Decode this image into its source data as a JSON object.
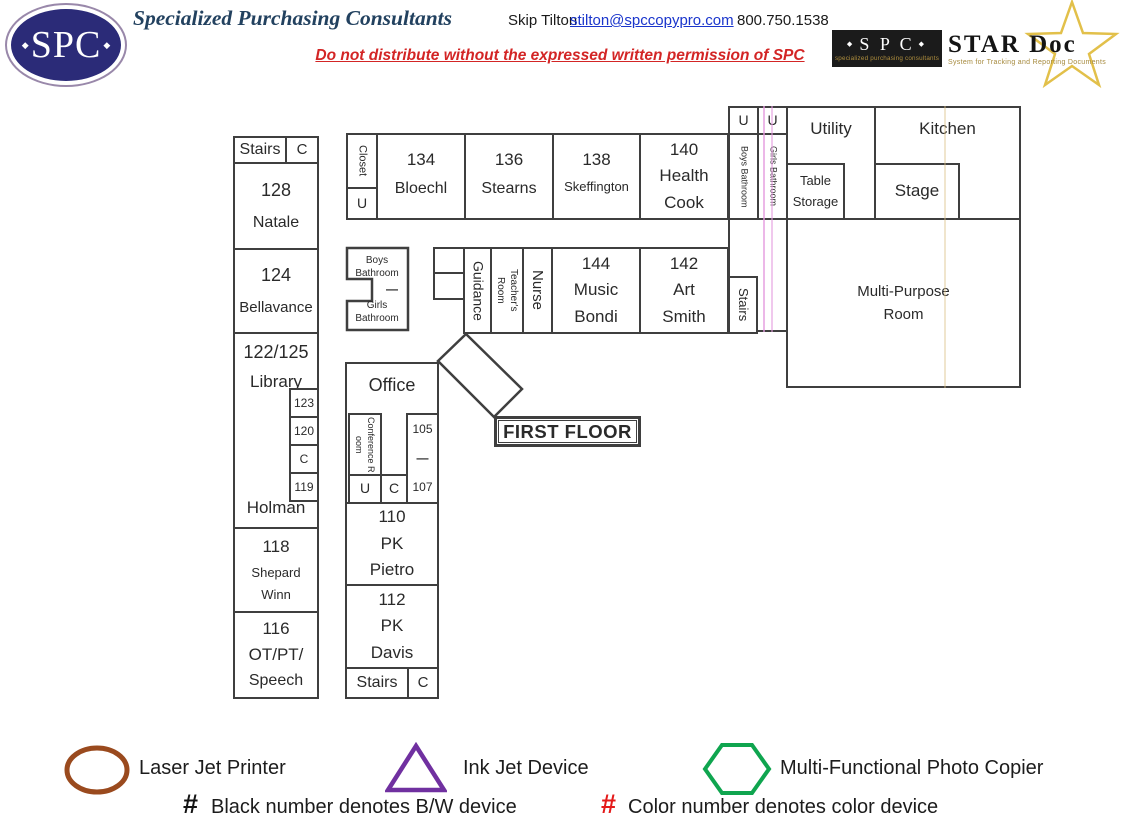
{
  "header": {
    "logo": {
      "text": "SPC",
      "diamond": "◆"
    },
    "company": "Specialized Purchasing Consultants",
    "contact_name": "Skip Tilton",
    "email": "stilton@spccopypro.com",
    "phone": "800.750.1538",
    "notice": "Do not distribute without the expressed written permission of SPC",
    "stardoc": {
      "spc": "S P C",
      "diamond": "◆",
      "spc_sub": "specialized purchasing consultants",
      "title": "STAR Doc",
      "subtitle": "System for Tracking and Reporting Documents"
    }
  },
  "plan": {
    "floor_label": "FIRST FLOOR",
    "rooms": {
      "stairs_nw": "Stairs",
      "c_nw": "C",
      "natale": {
        "num": "128",
        "name": "Natale"
      },
      "bellavance": {
        "num": "124",
        "name": "Bellavance"
      },
      "library": {
        "num": "122/125",
        "name": "Library",
        "teacher": "Holman",
        "cells": {
          "a": "123",
          "b": "120",
          "c": "C",
          "d": "119"
        }
      },
      "shepard": {
        "num": "118",
        "line1": "Shepard",
        "line2": "Winn"
      },
      "otpt": {
        "num": "116",
        "line1": "OT/PT/",
        "line2": "Speech"
      },
      "closet": {
        "label": "Closet",
        "u": "U"
      },
      "bloechl": {
        "num": "134",
        "name": "Bloechl"
      },
      "stearns": {
        "num": "136",
        "name": "Stearns"
      },
      "skeffington": {
        "num": "138",
        "name": "Skeffington"
      },
      "health": {
        "num": "140",
        "line1": "Health",
        "line2": "Cook"
      },
      "boys_bath_top": {
        "u": "U",
        "label": "Boys Bathroom"
      },
      "girls_bath_top": {
        "u": "U",
        "label": "Girls Bathroom"
      },
      "utility": "Utility",
      "kitchen": "Kitchen",
      "table_storage": {
        "line1": "Table",
        "line2": "Storage"
      },
      "stage": "Stage",
      "multi_purpose": {
        "line1": "Multi-Purpose",
        "line2": "Room"
      },
      "bath_mid": {
        "boys1": "Boys",
        "boys2": "Bathroom",
        "dash": "—",
        "girls1": "Girls",
        "girls2": "Bathroom"
      },
      "guidance": "Guidance",
      "teachers_room": "Teacher's Room",
      "nurse": "Nurse",
      "music": {
        "num": "144",
        "line1": "Music",
        "line2": "Bondi"
      },
      "art": {
        "num": "142",
        "line1": "Art",
        "line2": "Smith"
      },
      "stairs_mid": "Stairs",
      "office": {
        "label": "Office",
        "conference": "Conference Room",
        "u": "U",
        "c": "C",
        "r105": "105",
        "dash": "—",
        "r107": "107"
      },
      "pietro": {
        "num": "110",
        "line1": "PK",
        "line2": "Pietro"
      },
      "davis": {
        "num": "112",
        "line1": "PK",
        "line2": "Davis"
      },
      "stairs_s": "Stairs",
      "c_s": "C"
    }
  },
  "legend": {
    "laser": "Laser Jet Printer",
    "inkjet": "Ink Jet Device",
    "mfp": "Multi-Functional Photo Copier",
    "bw_hash": "#",
    "bw_text": "Black number denotes B/W device",
    "color_hash": "#",
    "color_text": "Color number denotes color device"
  },
  "colors": {
    "logo_navy": "#2b2b78",
    "title_blue": "#22415f",
    "link_blue": "#1a35cc",
    "notice_red": "#d32525",
    "wall_gray": "#3f3f3f",
    "star_gold": "#e2c04a",
    "legend_brown": "#9a4a1e",
    "legend_purple": "#7030a0",
    "legend_green": "#0fa54f",
    "legend_red": "#e41a1a"
  }
}
